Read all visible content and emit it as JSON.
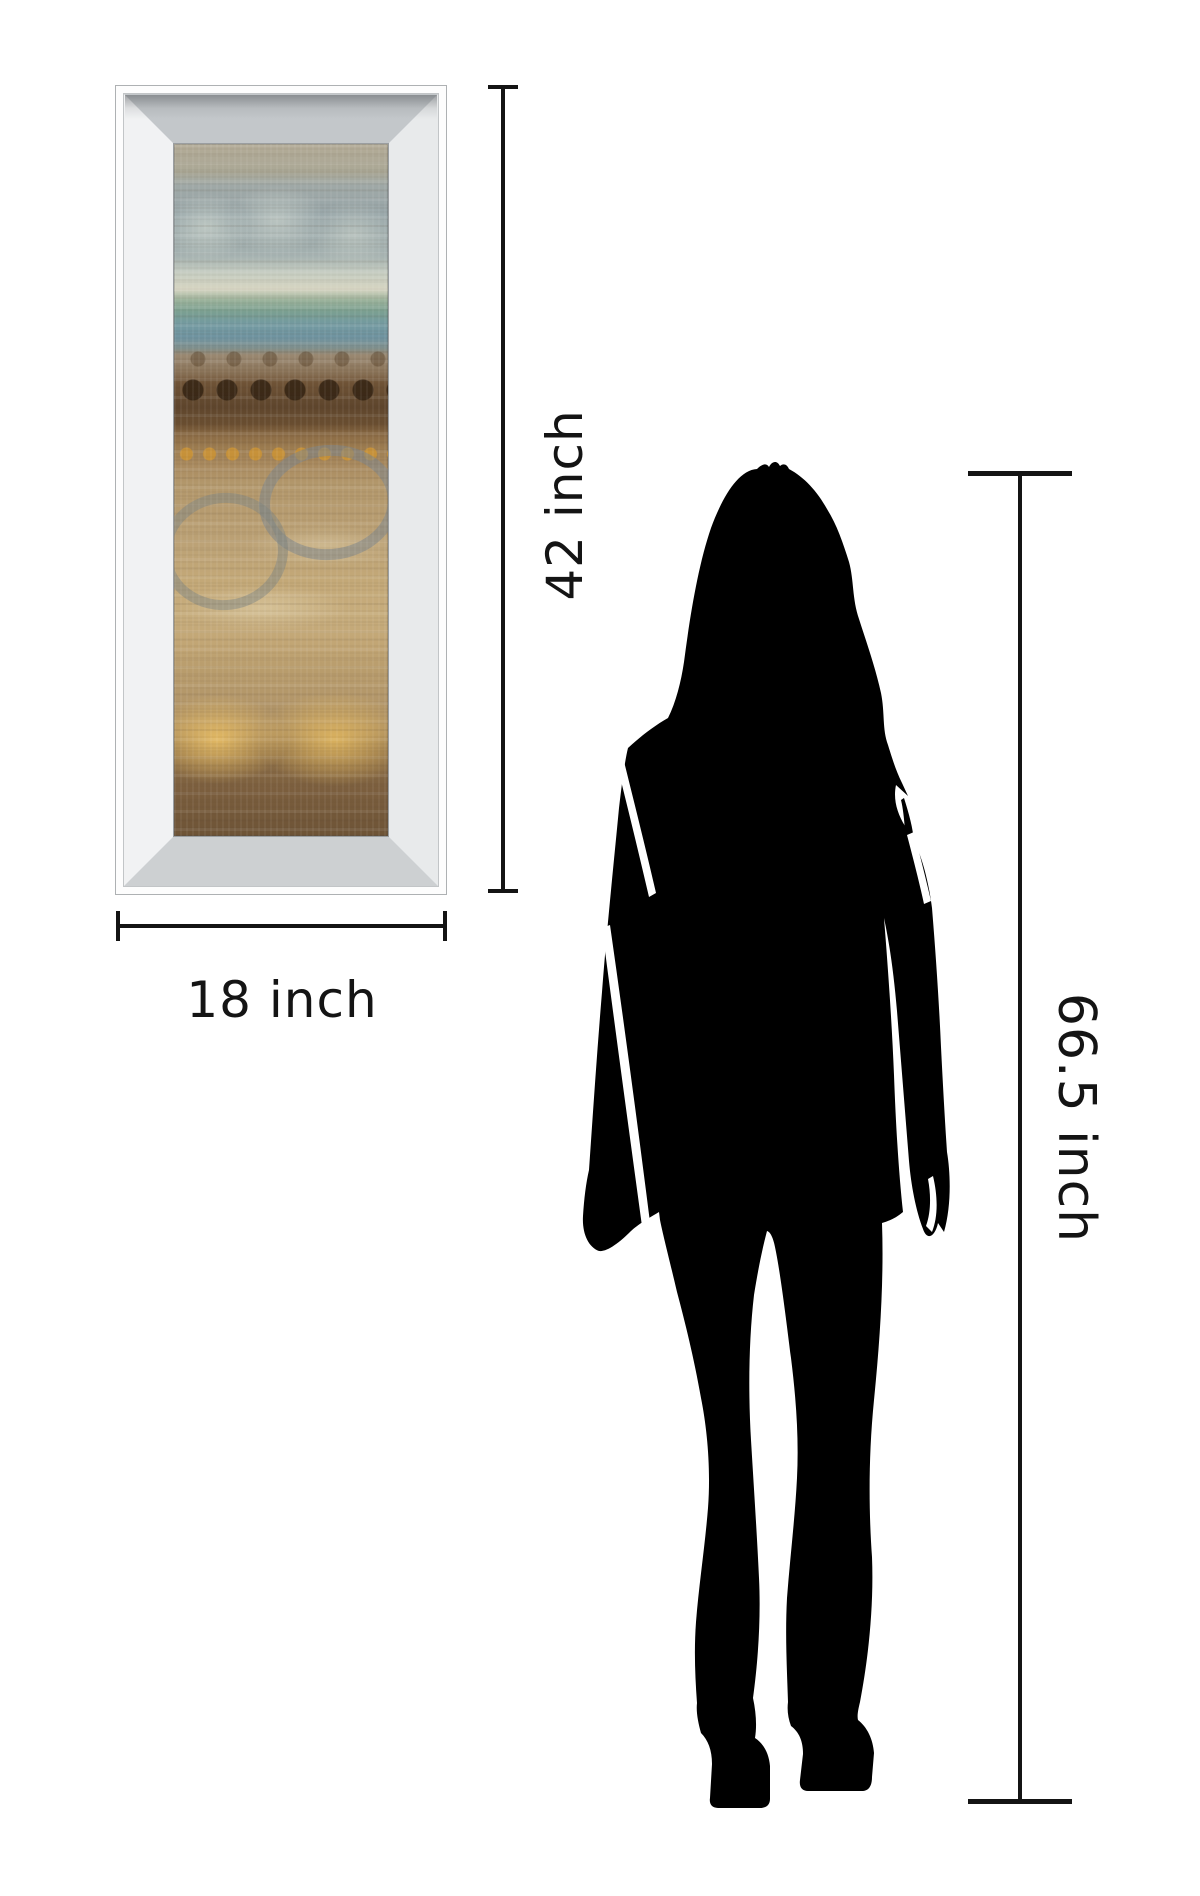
{
  "canvas": {
    "width": 1200,
    "height": 1896,
    "background": "#ffffff"
  },
  "comparison": {
    "artwork_frame": {
      "height_label": "42 inch",
      "width_label": "18 inch",
      "frame_style": "mirrored bevel frame",
      "frame_colors": {
        "outer_band": "#fdfdfd",
        "bevel_top": "#c3c7ca",
        "bevel_right": "#e8eaeb",
        "bevel_bottom": "#cdd0d2",
        "bevel_left": "#f1f2f3"
      },
      "art_description": "abstract banded painting: hazy blue-grey sky, teal horizon, brown bands with dark and gold dots, grey circle outlines, golden blobs on tan",
      "art_palette": [
        "#98a6a9",
        "#7ca08f",
        "#6f93a0",
        "#6f5336",
        "#c8912f",
        "#b69b6f",
        "#e2b968",
        "#6d5336"
      ]
    },
    "person": {
      "height_label": "66.5 inch",
      "icon": "woman-silhouette",
      "color": "#000000"
    },
    "dimension_line_color": "#141414",
    "label_text_color": "#141414"
  }
}
